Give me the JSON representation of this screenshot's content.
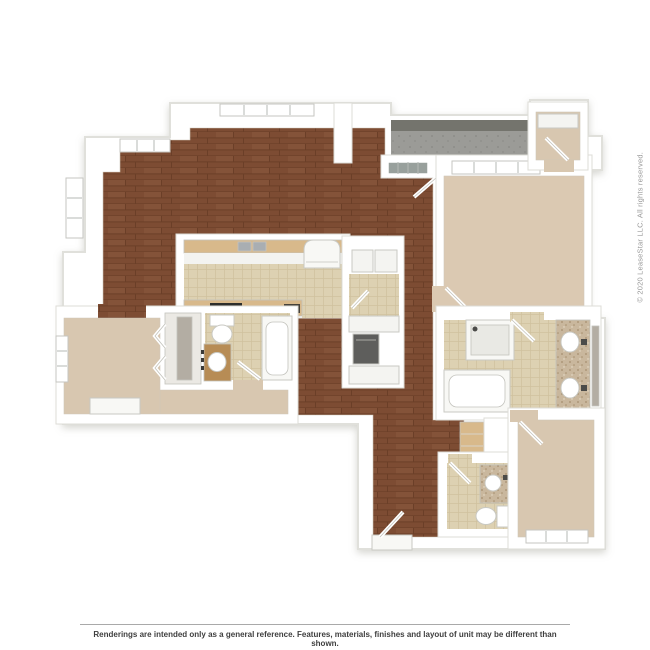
{
  "annotations": {
    "copyright": "© 2020 LeaseStar LLC. All rights reserved.",
    "disclaimer": "Renderings are intended only as a general reference. Features, materials, finishes and layout of unit may be different than shown."
  },
  "colors": {
    "wall": "#ffffff",
    "wall_edge": "#dddcd7",
    "hardwood": "#7d4c33",
    "hardwood_line": "#6b3f28",
    "hardwood_light": "#8c5b41",
    "tile": "#ddd1b2",
    "grout": "#cfc09d",
    "carpet": "#d8c7b0",
    "carpet_warm": "#dbc9b2",
    "closet_floor": "#ebe9e4",
    "balcony": "#9b9b97",
    "balcony_face": "#74746d",
    "balcony_dot": "#8d8d89",
    "counter_wood": "#d8b98b",
    "vanity_wood": "#b78c55",
    "speckle": "#c9b79d",
    "speckle_dark": "#a68e6e",
    "speckle_light": "#e9e0cd",
    "appliance": "#5e5e5c",
    "cooktop": "#2d2d2b",
    "glass_window": "#98a09c",
    "fixture": "#f8f8f5",
    "fixture_inner": "#ffffff",
    "basin": "#a9aeb2",
    "mirror": "#b3ada3",
    "shelf": "#f4f4f1",
    "cabinet_face": "#f3f3f0",
    "shower_floor": "#e9e9e4",
    "metal": "#4b4b49"
  }
}
